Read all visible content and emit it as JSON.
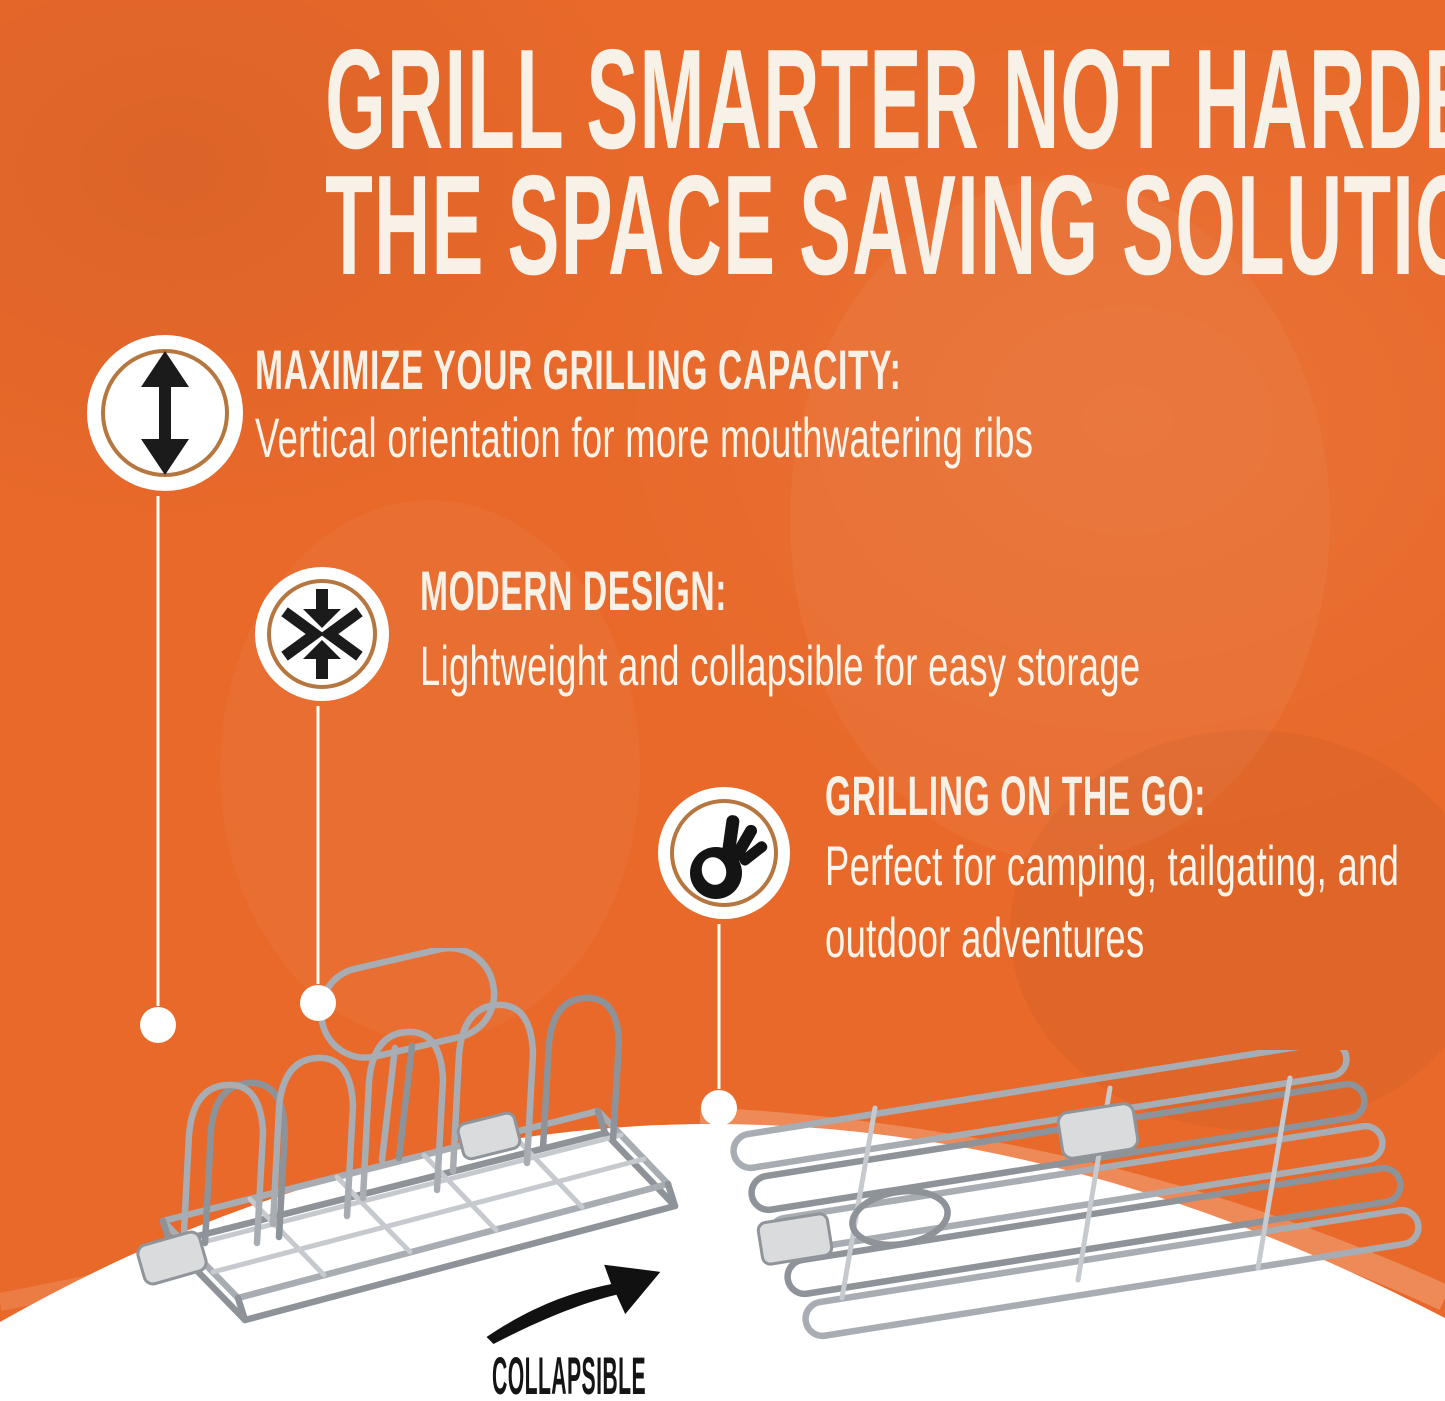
{
  "colors": {
    "background_orange": "#E8692A",
    "ring_accent": "#B5773F",
    "text_cream": "#F8F1E7",
    "icon_black": "#1B1B1B",
    "wire_gray": "#A7ADB3",
    "curve_white": "#FFFFFF"
  },
  "title": {
    "line1": "GRILL SMARTER NOT HARDER:",
    "line2": "THE SPACE SAVING SOLUTION"
  },
  "features": [
    {
      "icon": "vertical-double-arrow-icon",
      "heading": "MAXIMIZE YOUR GRILLING CAPACITY:",
      "body": "Vertical orientation for more mouthwatering ribs"
    },
    {
      "icon": "compress-arrows-icon",
      "heading": "MODERN DESIGN:",
      "body": "Lightweight and collapsible for easy storage"
    },
    {
      "icon": "ok-hand-icon",
      "heading": "GRILLING ON THE GO:",
      "body": "Perfect for camping, tailgating, and outdoor adventures"
    }
  ],
  "footer": {
    "caption": "COLLAPSIBLE"
  },
  "images": {
    "left_product": "expanded rib rack (wire, upright)",
    "right_product": "collapsed rib rack (wire, flat)"
  }
}
